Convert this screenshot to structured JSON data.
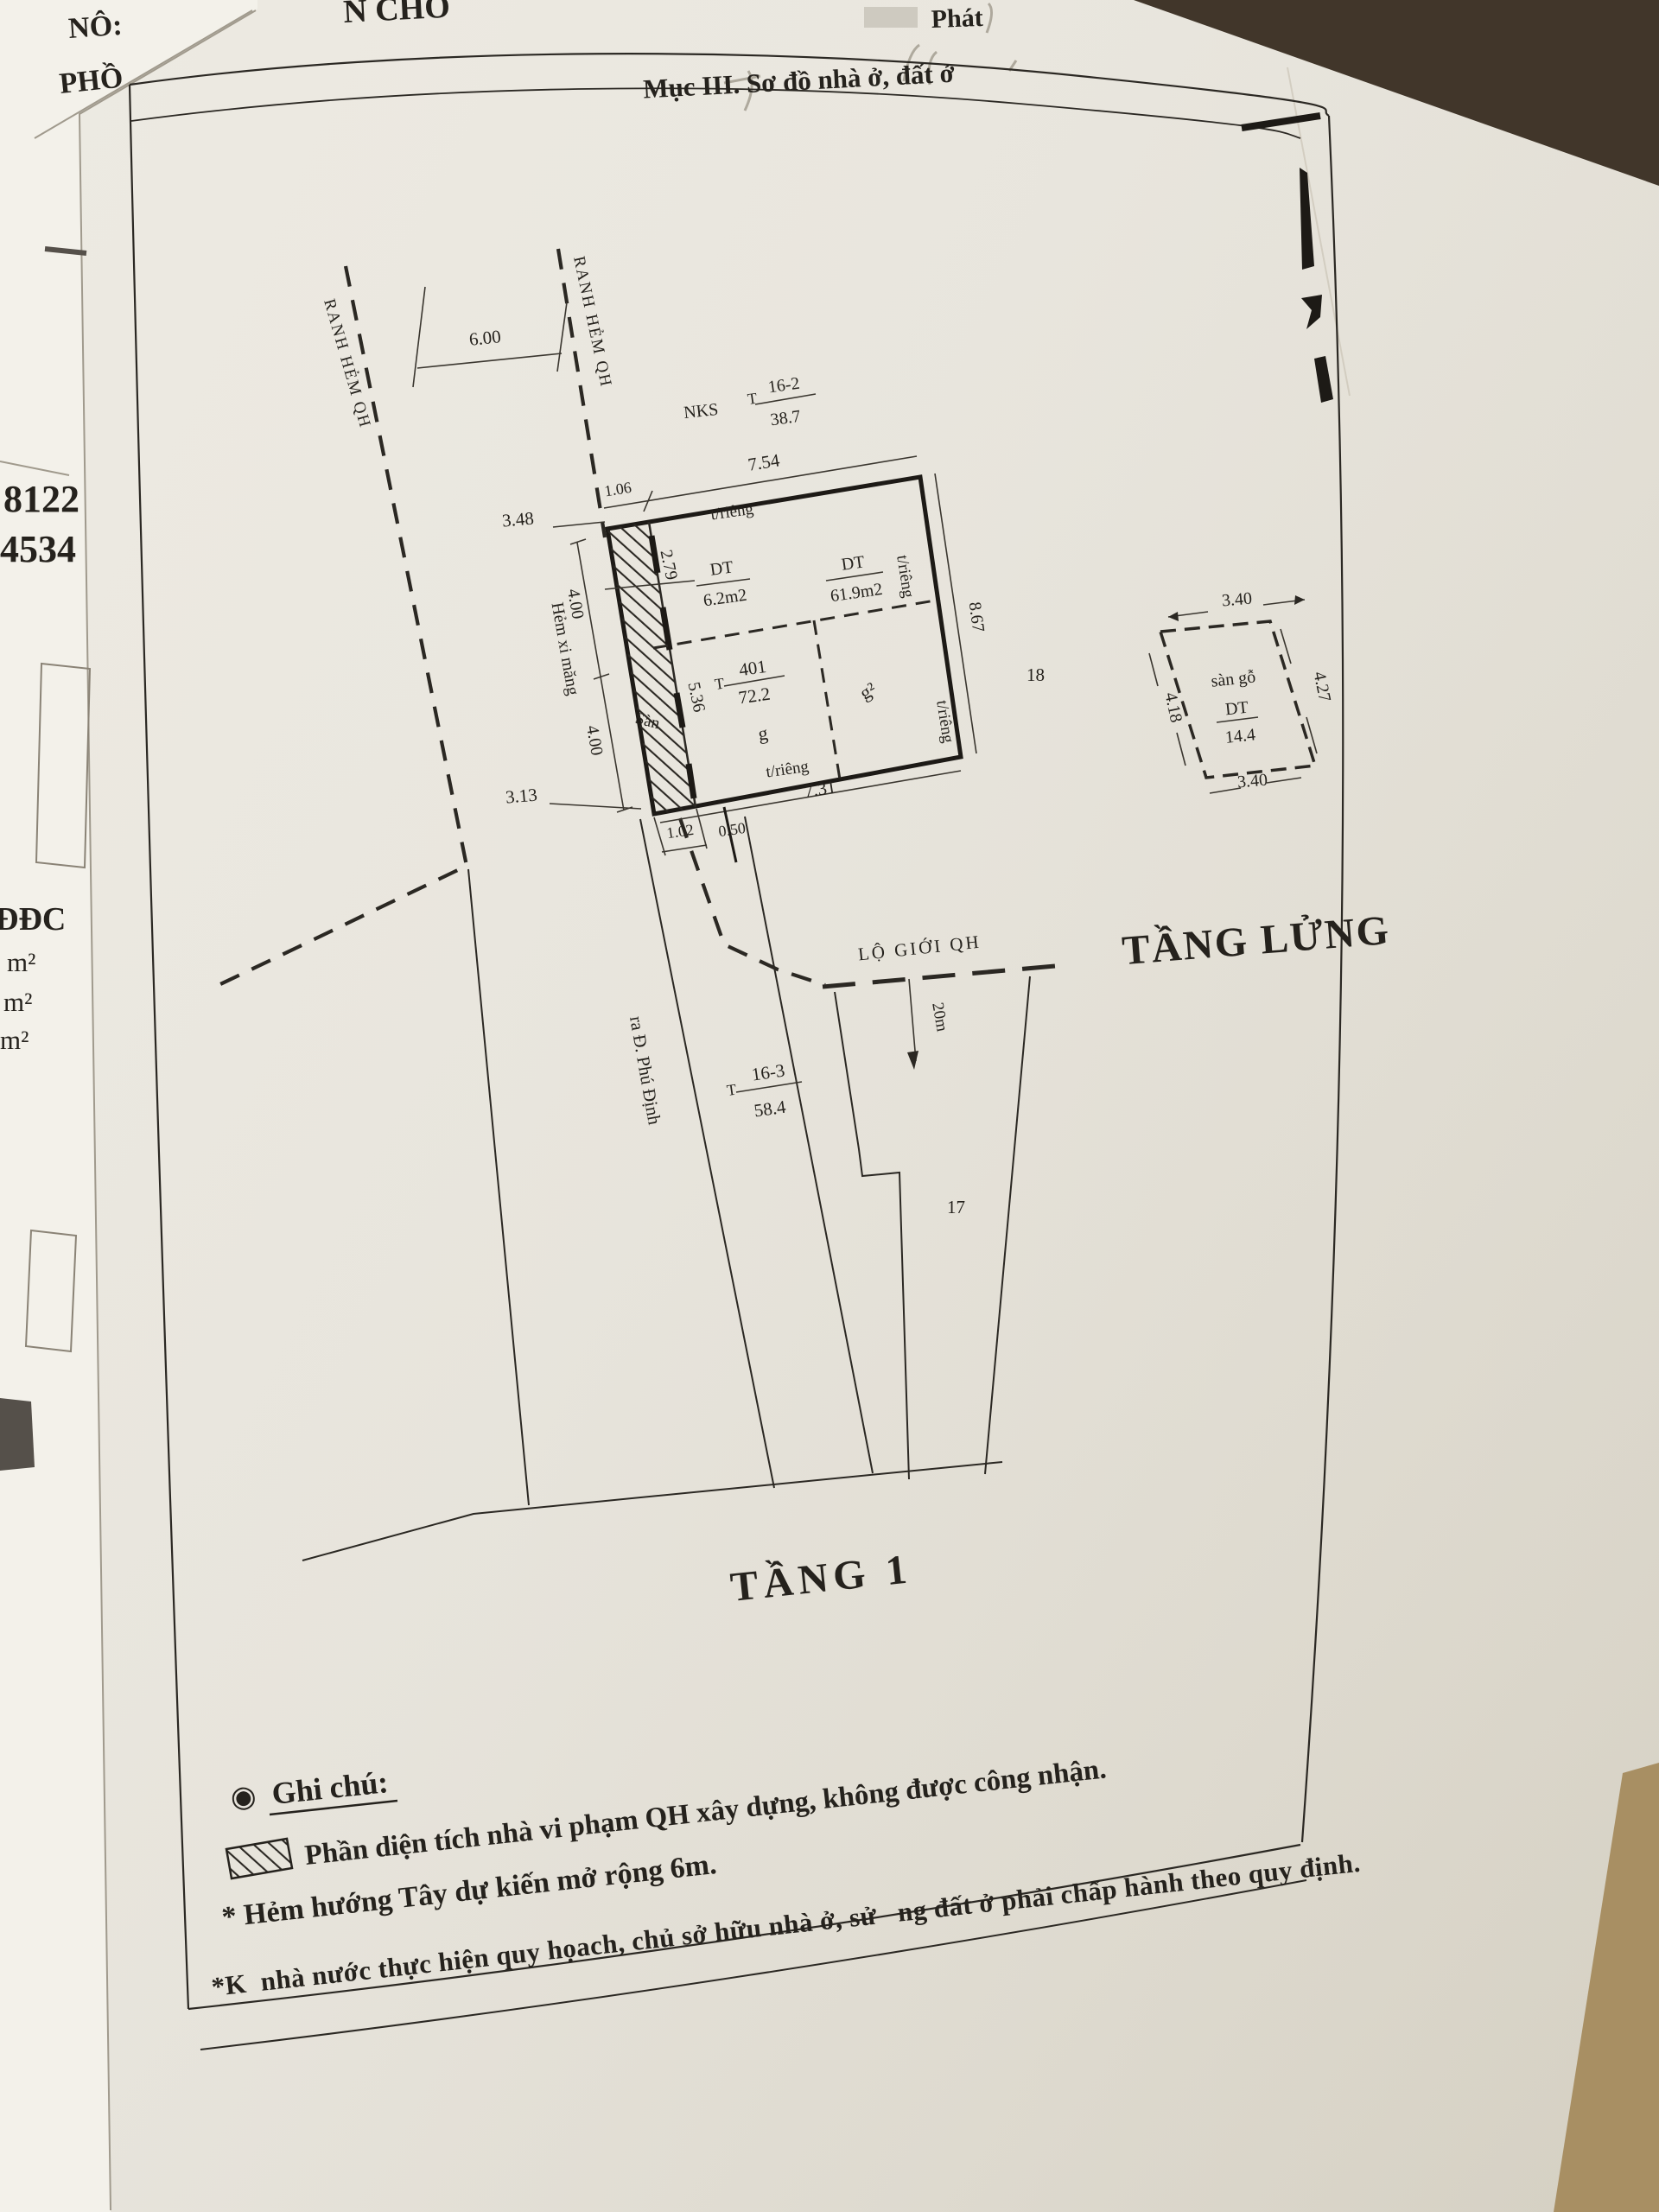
{
  "document": {
    "section_title": "Mục III. Sơ đồ nhà ở, đất ở",
    "floor1_title": "TẦNG 1",
    "mezzanine_title": "TẦNG LỬNG"
  },
  "surroundings": {
    "top_left_line1": "NÔ:",
    "top_left_line2": "PHỒ",
    "top_center_fragment": "N CHO",
    "top_right_fragment": "Phát",
    "left_margin": {
      "number1": "8122",
      "number2": "4534",
      "label": "ĐĐC",
      "unit1": "m²",
      "unit2": "m²",
      "unit3": "m²"
    }
  },
  "diagram": {
    "boundaries": {
      "ranh_hem_1": "RANH HẺM QH",
      "ranh_hem_2": "RANH HẺM QH",
      "lo_gioi": "LỘ GIỚI QH",
      "road_width": "20m",
      "alley": "Hẻm xi măng",
      "to_street": "ra Đ. Phú Định"
    },
    "parcels": {
      "nks": "NKS",
      "p16_2": {
        "prefix": "T",
        "num": "16-2",
        "den": "38.7"
      },
      "p401": {
        "prefix": "T",
        "num": "401",
        "den": "72.2"
      },
      "p16_3": {
        "prefix": "T",
        "num": "16-3",
        "den": "58.4"
      },
      "n18": "18",
      "n17": "17"
    },
    "rooms": {
      "g": "g",
      "g2": "g²",
      "san": "Sàn",
      "san_go": "sàn gỗ",
      "dt1_label": "DT",
      "dt1_value": "6.2m2",
      "dt2_label": "DT",
      "dt2_value": "61.9m2",
      "dt3_label": "DT",
      "dt3_value": "14.4",
      "trieng_top": "t/riêng",
      "trieng_right_upper": "t/riêng",
      "trieng_right_lower": "t/riêng",
      "trieng_bottom": "t/riêng"
    },
    "dimensions": {
      "alley_width": "6.00",
      "top_offset": "1.06",
      "top": "7.54",
      "gap_left": "3.48",
      "strip_upper": "2.79",
      "left_upper": "4.00",
      "left_lower": "4.00",
      "strip_lower": "5.36",
      "right": "8.67",
      "gap_bottom": "3.13",
      "bottom": "7.31",
      "bottom_offset1": "1.02",
      "bottom_offset2": "0.50",
      "mezz_top": "3.40",
      "mezz_right": "4.27",
      "mezz_left": "4.18",
      "mezz_bottom": "3.40"
    }
  },
  "notes": {
    "bullet": "◉",
    "heading": "Ghi chú:",
    "line1": "Phần diện tích nhà vi phạm QH xây dựng, không được công nhận.",
    "line2": "* Hẻm hướng Tây dự kiến mở rộng 6m.",
    "line3": "*K  nhà nước thực hiện quy họach, chủ sở hữu nhà ở, sử   ng đất ở phải chấp hành theo quy định."
  },
  "colors": {
    "ink": "#25221d",
    "paper": "#e9e6de",
    "underlying_sheet": "#f3f1ea",
    "desk_dark": "#41362a",
    "desk_tan": "#a88f63"
  }
}
